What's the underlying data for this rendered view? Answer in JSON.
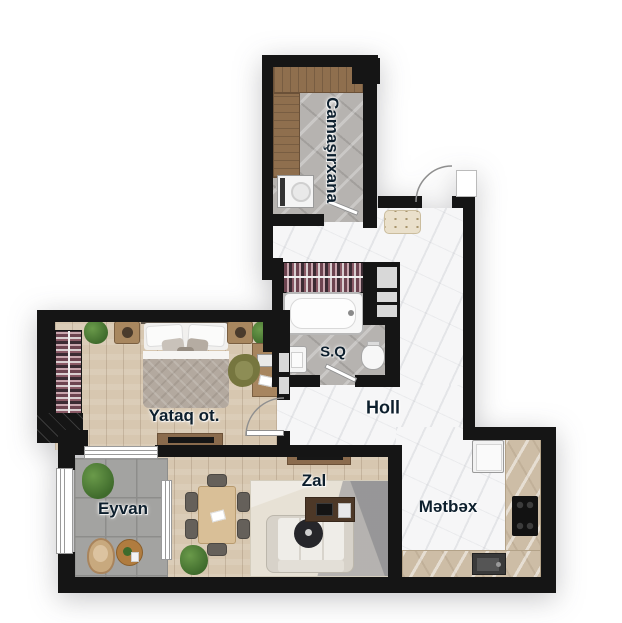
{
  "rooms": {
    "laundry": {
      "label": "Camaşırxana",
      "orientation": "vertical"
    },
    "bathroom": {
      "label": "S.Q"
    },
    "hall": {
      "label": "Holl"
    },
    "bedroom": {
      "label": "Yataq ot."
    },
    "balcony": {
      "label": "Eyvan"
    },
    "living": {
      "label": "Zal"
    },
    "kitchen": {
      "label": "Mətbəx"
    }
  },
  "palette": {
    "wall": "#151515",
    "marble_floor": "#f6f6f7",
    "wood_floor": "#d7c7b0",
    "gray_tile": "#b6b3b0",
    "balcony_tile": "#a3a3a1",
    "counter": "#cdbda6",
    "label_text": "#0d1f2d",
    "plant": "#4c7a38",
    "ottoman": "#eae0cb"
  }
}
